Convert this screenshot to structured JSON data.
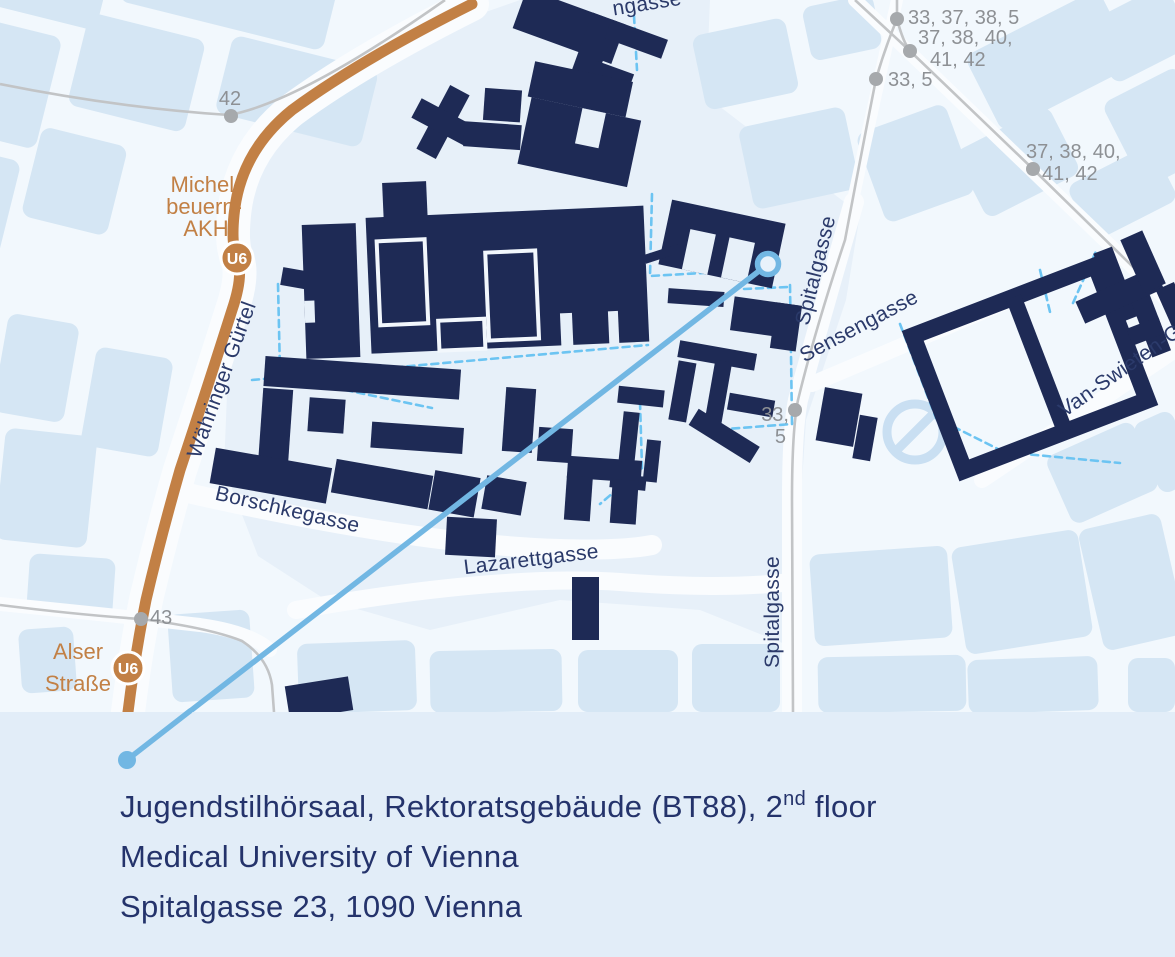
{
  "colors": {
    "navy": "#1e2a55",
    "label_navy": "#2b3a6a",
    "orange": "#c28045",
    "route_blue": "#72b7e3",
    "dash_blue": "#6cc4f2",
    "line_gray": "#c2c4c6",
    "stop_gray": "#a6a9ac",
    "text_gray": "#8d9094",
    "block_blue": "#d5e6f4",
    "campus_blue": "#e7f0f9",
    "base": "#f2f8fd",
    "street_white": "#fafcfe",
    "watermark": "#c9dff2",
    "band_bg": "#e2edf8",
    "address_navy": "#24336b"
  },
  "labels": {
    "street_fragment_top": "ngasse",
    "waehringer_guertel": "Währinger Gürtel",
    "borschkegasse": "Borschkegasse",
    "lazarettgasse": "Lazarettgasse",
    "spitalgasse_upper": "Spitalgasse",
    "spitalgasse_lower": "Spitalgasse",
    "sensengasse": "Sensengasse",
    "van_swieten": "Van-Swieten-G"
  },
  "stations": {
    "michelbeuern_line1": "Michel-",
    "michelbeuern_line2": "beuern-",
    "michelbeuern_line3": "AKH",
    "alser_line1": "Alser",
    "alser_line2": "Straße",
    "u6_badge": "U6"
  },
  "transit_stops": {
    "stop_42": "42",
    "stop_43": "43",
    "stop_33_37_38_5": "33, 37, 38, 5",
    "stop_37_38_40_line1": "37, 38, 40,",
    "stop_37_38_40_line2": "41, 42",
    "stop_33_5": "33, 5",
    "stop_33_5_mid_line1": "33,",
    "stop_33_5_mid_line2": "5",
    "stop_37_38_40b_line1": "37, 38, 40,",
    "stop_37_38_40b_line2": "41, 42"
  },
  "address": {
    "line1_pre": "Jugendstilhörsaal, Rektoratsgebäude (BT88), 2",
    "line1_sup": "nd",
    "line1_post": " floor",
    "line2": "Medical University of Vienna",
    "line3": "Spitalgasse 23, 1090 Vienna"
  }
}
